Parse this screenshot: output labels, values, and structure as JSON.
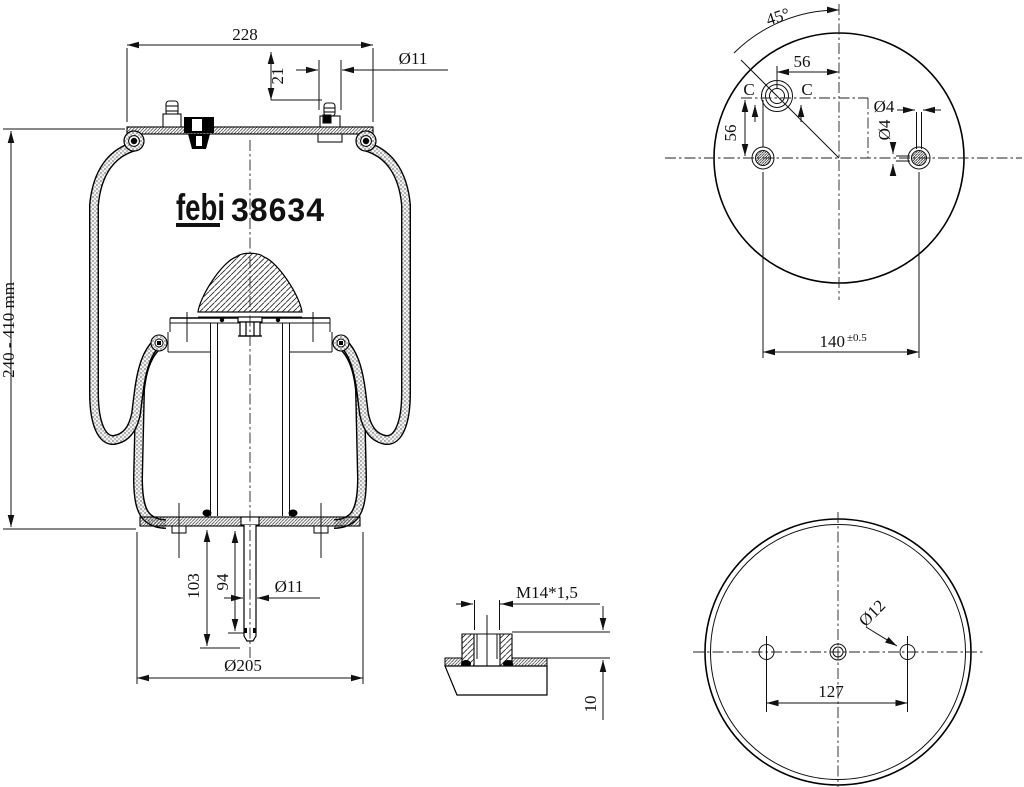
{
  "drawing": {
    "brand_logo": "febi",
    "part_number": "38634",
    "side_view": {
      "top_width": "228",
      "stud_height": "21",
      "top_stud_diameter": "Ø11",
      "design_height": "240 - 410 mm",
      "lower_stud_length_outer": "103",
      "lower_stud_length_inner": "94",
      "lower_stud_diameter": "Ø11",
      "piston_diameter": "Ø205"
    },
    "top_view": {
      "port_angle": "45°",
      "port_offset_horizontal": "56",
      "port_offset_vertical": "56",
      "section_label_left": "C",
      "section_label_right": "C",
      "vent_diameter_horizontal": "Ø4",
      "vent_diameter_vertical": "Ø4",
      "stud_spacing": "140",
      "stud_spacing_tolerance": "±0.5"
    },
    "detail_view": {
      "thread": "M14*1,5",
      "boss_height": "10"
    },
    "bottom_view": {
      "hole_diameter": "Ø12",
      "hole_spacing": "127"
    }
  }
}
